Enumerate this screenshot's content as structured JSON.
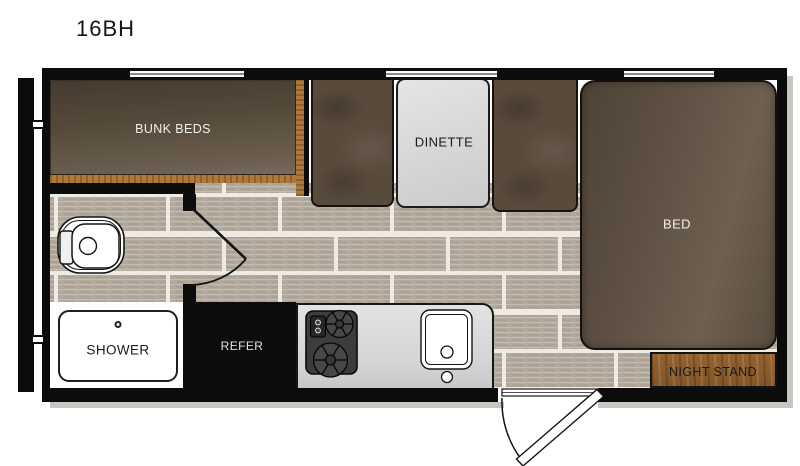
{
  "title": "16BH",
  "rooms": {
    "bunk_beds": {
      "label": "BUNK BEDS"
    },
    "dinette": {
      "label": "DINETTE"
    },
    "bed": {
      "label": "BED"
    },
    "shower": {
      "label": "SHOWER"
    },
    "refrigerator": {
      "label": "REFER"
    },
    "night_stand": {
      "label": "NIGHT STAND"
    }
  },
  "fixtures": [
    "toilet",
    "shower-pan",
    "two-burner-stove",
    "kitchen-sink",
    "entry-door",
    "bathroom-door",
    "windows",
    "hitch-tongue"
  ],
  "colors": {
    "wall": "#0c0c0c",
    "tile_floor": "#b2a99d",
    "grout": "#eeebe5",
    "upholstery_brown": "#594b3c",
    "bed_brown": "#5d5043",
    "wood_trim": "#ad7a3e",
    "night_stand_wood": "#9a6a38",
    "counter_gray": "#d9d9d9",
    "table_gray": "#d9d8d6"
  }
}
